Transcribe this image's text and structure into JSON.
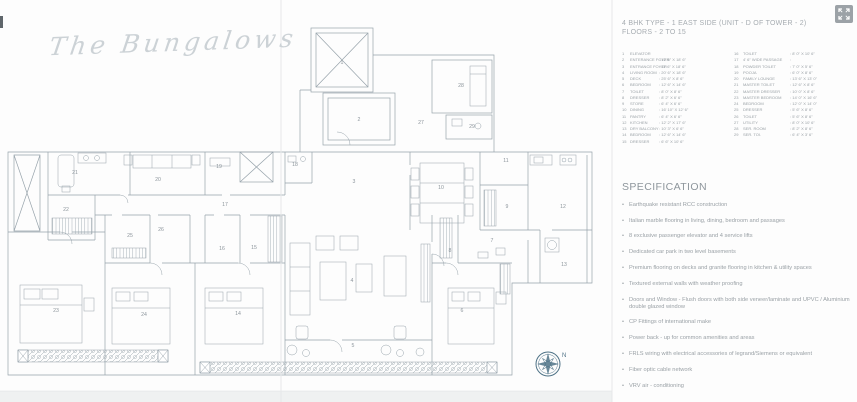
{
  "colors": {
    "plan_line": "#97a3ab",
    "fold_line": "#e6e8e9",
    "muted_text": "#9aa1a6",
    "compass_accent": "#4e7286",
    "fullscreen_button_bg": "#9ca2a7"
  },
  "brand": {
    "logo_text": "The Bungalows"
  },
  "header": {
    "title_line1": "4 BHK TYPE - 1 EAST SIDE (UNIT - D OF TOWER - 2)",
    "title_line2": "FLOORS - 2 TO 15"
  },
  "controls": {
    "fullscreen_icon": "expand-arrows-icon"
  },
  "legend": {
    "column1": [
      {
        "num": "1",
        "name": "ELEVATOR",
        "dims": ""
      },
      {
        "num": "2",
        "name": "ENTERANCE FOYER",
        "dims": ": 12' 6\" X 18' 6\""
      },
      {
        "num": "3",
        "name": "ENTRANCE FOYER",
        "dims": ": 11' 6\" X 18' 6\""
      },
      {
        "num": "4",
        "name": "LIVING ROOM",
        "dims": ": 20' 6\" X 18' 6\""
      },
      {
        "num": "5",
        "name": "DECK",
        "dims": ": 25' 6\" X 8' 6\""
      },
      {
        "num": "6",
        "name": "BEDROOM",
        "dims": ": 12' 6\" X 14' 6\""
      },
      {
        "num": "7",
        "name": "TOILET",
        "dims": ": 8' 0\" X 8' 6\""
      },
      {
        "num": "8",
        "name": "DRESSER",
        "dims": ": 8' 2\" X 6' 6\""
      },
      {
        "num": "9",
        "name": "STORE",
        "dims": ": 6' 4\" X 6' 6\""
      },
      {
        "num": "10",
        "name": "DINING",
        "dims": ": 16' 10\" X 12' 6\""
      },
      {
        "num": "11",
        "name": "PANTRY",
        "dims": ": 6' 4\" X 6' 6\""
      },
      {
        "num": "12",
        "name": "KITCHEN",
        "dims": ": 12' 2\" X 17' 6\""
      },
      {
        "num": "13",
        "name": "DRY BALCONY",
        "dims": ": 10' 3\" X 6' 6\""
      },
      {
        "num": "14",
        "name": "BEDROOM",
        "dims": ": 12' 6\" X 14' 6\""
      },
      {
        "num": "15",
        "name": "DRESSER",
        "dims": ": 6' 6\" X 10' 6\""
      }
    ],
    "column2": [
      {
        "num": "16",
        "name": "TOILET",
        "dims": ": 8' 0\" X 10' 6\""
      },
      {
        "num": "17",
        "name": "4' 6\" WIDE PASSAGE",
        "dims": ":"
      },
      {
        "num": "18",
        "name": "POWDER TOILET",
        "dims": ": 7' 0\" X 5' 6\""
      },
      {
        "num": "19",
        "name": "POOJA",
        "dims": ": 6' 0\" X 8' 6\""
      },
      {
        "num": "20",
        "name": "FAMILY LOUNGE",
        "dims": ": 13' 6\" X 13' 0\""
      },
      {
        "num": "21",
        "name": "MASTER TOILET",
        "dims": ": 12' 6\" X 8' 6\""
      },
      {
        "num": "22",
        "name": "MASTER DRESSER",
        "dims": ": 10' 0\" X 8' 6\""
      },
      {
        "num": "23",
        "name": "MASTER BEDROOM",
        "dims": ": 14' 0\" X 16' 6\""
      },
      {
        "num": "24",
        "name": "BEDROOM",
        "dims": ": 12' 0\" X 14' 0\""
      },
      {
        "num": "25",
        "name": "DRESSER",
        "dims": ": 5' 6\" X 8' 6\""
      },
      {
        "num": "26",
        "name": "TOILET",
        "dims": ": 5' 6\" X 8' 6\""
      },
      {
        "num": "27",
        "name": "UTILITY",
        "dims": ": 8' 0\" X 10' 6\""
      },
      {
        "num": "28",
        "name": "SER. ROOM",
        "dims": ": 8' 2\" X 8' 6\""
      },
      {
        "num": "29",
        "name": "SER. TOI.",
        "dims": ": 6' 4\" X 3' 6\""
      }
    ]
  },
  "specification": {
    "heading": "SPECIFICATION",
    "items": [
      "Earthquake resistant RCC construction",
      "Italian marble flooring in living, dining, bedroom and passages",
      "8 exclusive passenger elevator and 4 service lifts",
      "Dedicated car park in two level basements",
      "Premium flooring on decks and granite flooring in kitchen & utility spaces",
      "Textured external walls with weather proofing",
      "Doors and Window - Flush doors with both side veneer/laminate and UPVC / Aluminium double glazed window",
      "CP Fittings of international make",
      "Power back - up for common amenities and areas",
      "FRLS wiring with electrical accessories of legrand/Siemens or equivalent",
      "Fiber optic cable network",
      "VRV air - conditioning"
    ]
  },
  "plan": {
    "compass_label": "N",
    "room_labels": [
      {
        "num": "1",
        "x": 342,
        "y": 64
      },
      {
        "num": "2",
        "x": 359,
        "y": 121
      },
      {
        "num": "3",
        "x": 354,
        "y": 183
      },
      {
        "num": "4",
        "x": 352,
        "y": 282
      },
      {
        "num": "5",
        "x": 353,
        "y": 347
      },
      {
        "num": "6",
        "x": 462,
        "y": 312
      },
      {
        "num": "7",
        "x": 492,
        "y": 242
      },
      {
        "num": "8",
        "x": 450,
        "y": 252
      },
      {
        "num": "9",
        "x": 507,
        "y": 208
      },
      {
        "num": "10",
        "x": 441,
        "y": 189
      },
      {
        "num": "11",
        "x": 506,
        "y": 162
      },
      {
        "num": "12",
        "x": 563,
        "y": 208
      },
      {
        "num": "13",
        "x": 564,
        "y": 266
      },
      {
        "num": "14",
        "x": 238,
        "y": 315
      },
      {
        "num": "15",
        "x": 254,
        "y": 249
      },
      {
        "num": "16",
        "x": 222,
        "y": 250
      },
      {
        "num": "17",
        "x": 225,
        "y": 206
      },
      {
        "num": "18",
        "x": 295,
        "y": 166
      },
      {
        "num": "19",
        "x": 219,
        "y": 168
      },
      {
        "num": "20",
        "x": 158,
        "y": 181
      },
      {
        "num": "21",
        "x": 75,
        "y": 174
      },
      {
        "num": "22",
        "x": 66,
        "y": 211
      },
      {
        "num": "23",
        "x": 56,
        "y": 312
      },
      {
        "num": "24",
        "x": 144,
        "y": 316
      },
      {
        "num": "25",
        "x": 130,
        "y": 237
      },
      {
        "num": "26",
        "x": 161,
        "y": 231
      },
      {
        "num": "27",
        "x": 421,
        "y": 124
      },
      {
        "num": "28",
        "x": 461,
        "y": 87
      },
      {
        "num": "29",
        "x": 472,
        "y": 128
      }
    ]
  }
}
